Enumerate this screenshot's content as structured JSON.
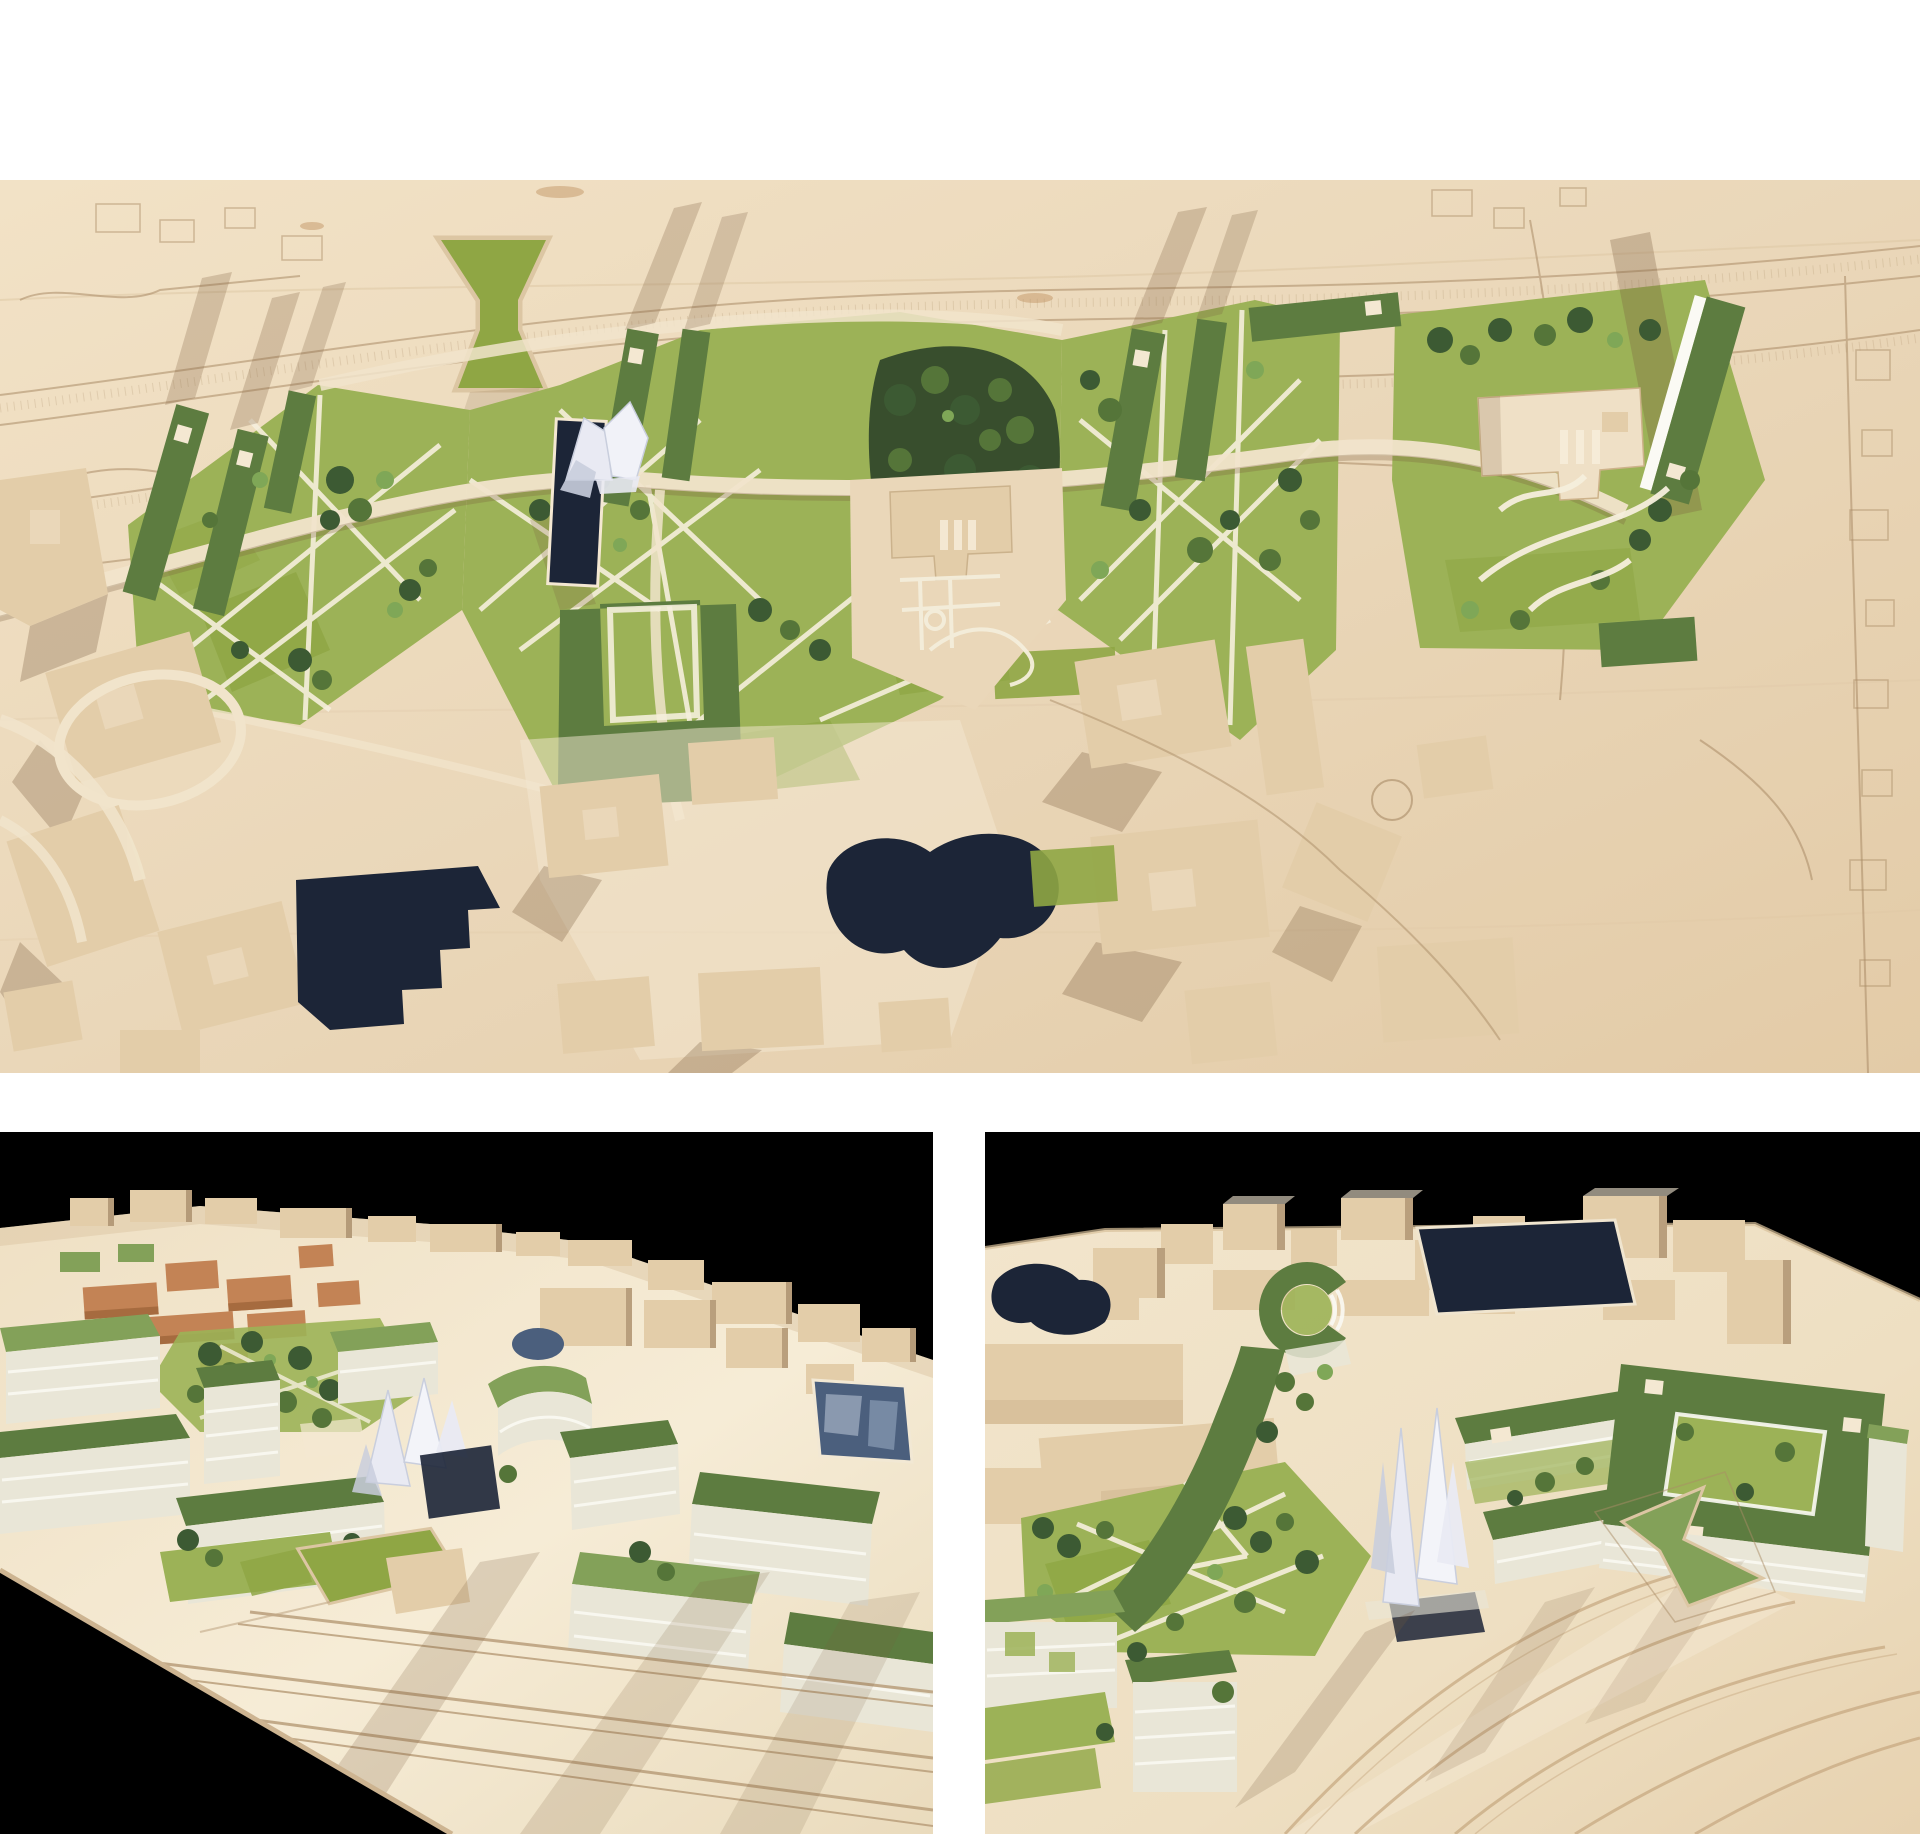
{
  "page": {
    "kind": "Architectural model photo board",
    "background": "#ffffff",
    "layout": "one full-width aerial photograph on top, two perspective photographs side by side below"
  },
  "panels": [
    {
      "id": "aerial-top-view",
      "label": "top-down aerial photo of wooden urban model",
      "description": "Top-down photograph of a pale wooden city model. A belt of parks crosses the middle: light green lawns with white diagonal paths, dark green roof slabs with small skylights, dense tree clusters, a navy canal beside a white crystalline pavilion, an hourglass-shaped green ramp, a U-shaped green roof building and a beige mansion with formal gardens. Around the belt the existing city is plain carved wood with block shadows, a navy rectangular basin lower left and a navy blob-shaped pond at the centre; the far right is empty board with engraved roads and house outlines."
    },
    {
      "id": "perspective-view-west",
      "label": "perspective photo of model against black background",
      "description": "Low perspective photograph, black backdrop. Rows of translucent glass slab buildings with flat green roofs stand over lawn courtyards and trees; terracotta and plain wooden blocks sit behind, a reflective pool at the right, a bent white glass tower in the middle, a small green ramp and engraved track lines cross the wooden apron in the foreground; the board corner cuts away to black at lower left."
    },
    {
      "id": "perspective-view-east",
      "label": "perspective photo of model against black background",
      "description": "Low perspective photograph, black backdrop. Wooden city cubes and a square navy basin behind; a curved C-shaped green-roof building, a white crystalline tower over a dark pool, green roof slabs and a courtyard block around a lawn, lawns with white paths and trees at the left, glass blocks with green panels in the lower left corner, and a wide engraved wooden apron with the hourglass green ramp in the foreground."
    }
  ],
  "palette": {
    "white": "#ffffff",
    "black": "#000000",
    "board": "#ead7b9",
    "boardLight": "#f4e8d2",
    "boardDark": "#dcc6a3",
    "engrave": "#a98b66",
    "roadLight": "#f1e4cb",
    "shadow": "#7a5c3e",
    "lawn": "#9cb257",
    "lawnBright": "#8fa644",
    "roofGreen": "#5d7c40",
    "roofGreenLight": "#83a159",
    "treeDark": "#3c5a33",
    "treeMid": "#557539",
    "treeLight": "#7fa757",
    "water": "#1c2537",
    "pool": "#4b5f7d",
    "glass": "#e9e6d7",
    "glassStripe": "#fbfaf4",
    "crystal": "#e9eaf3",
    "crystalShade": "#c9cedd",
    "terracotta": "#c38355",
    "blockBeige": "#e3cda9",
    "blockShadow": "#8f7252"
  }
}
